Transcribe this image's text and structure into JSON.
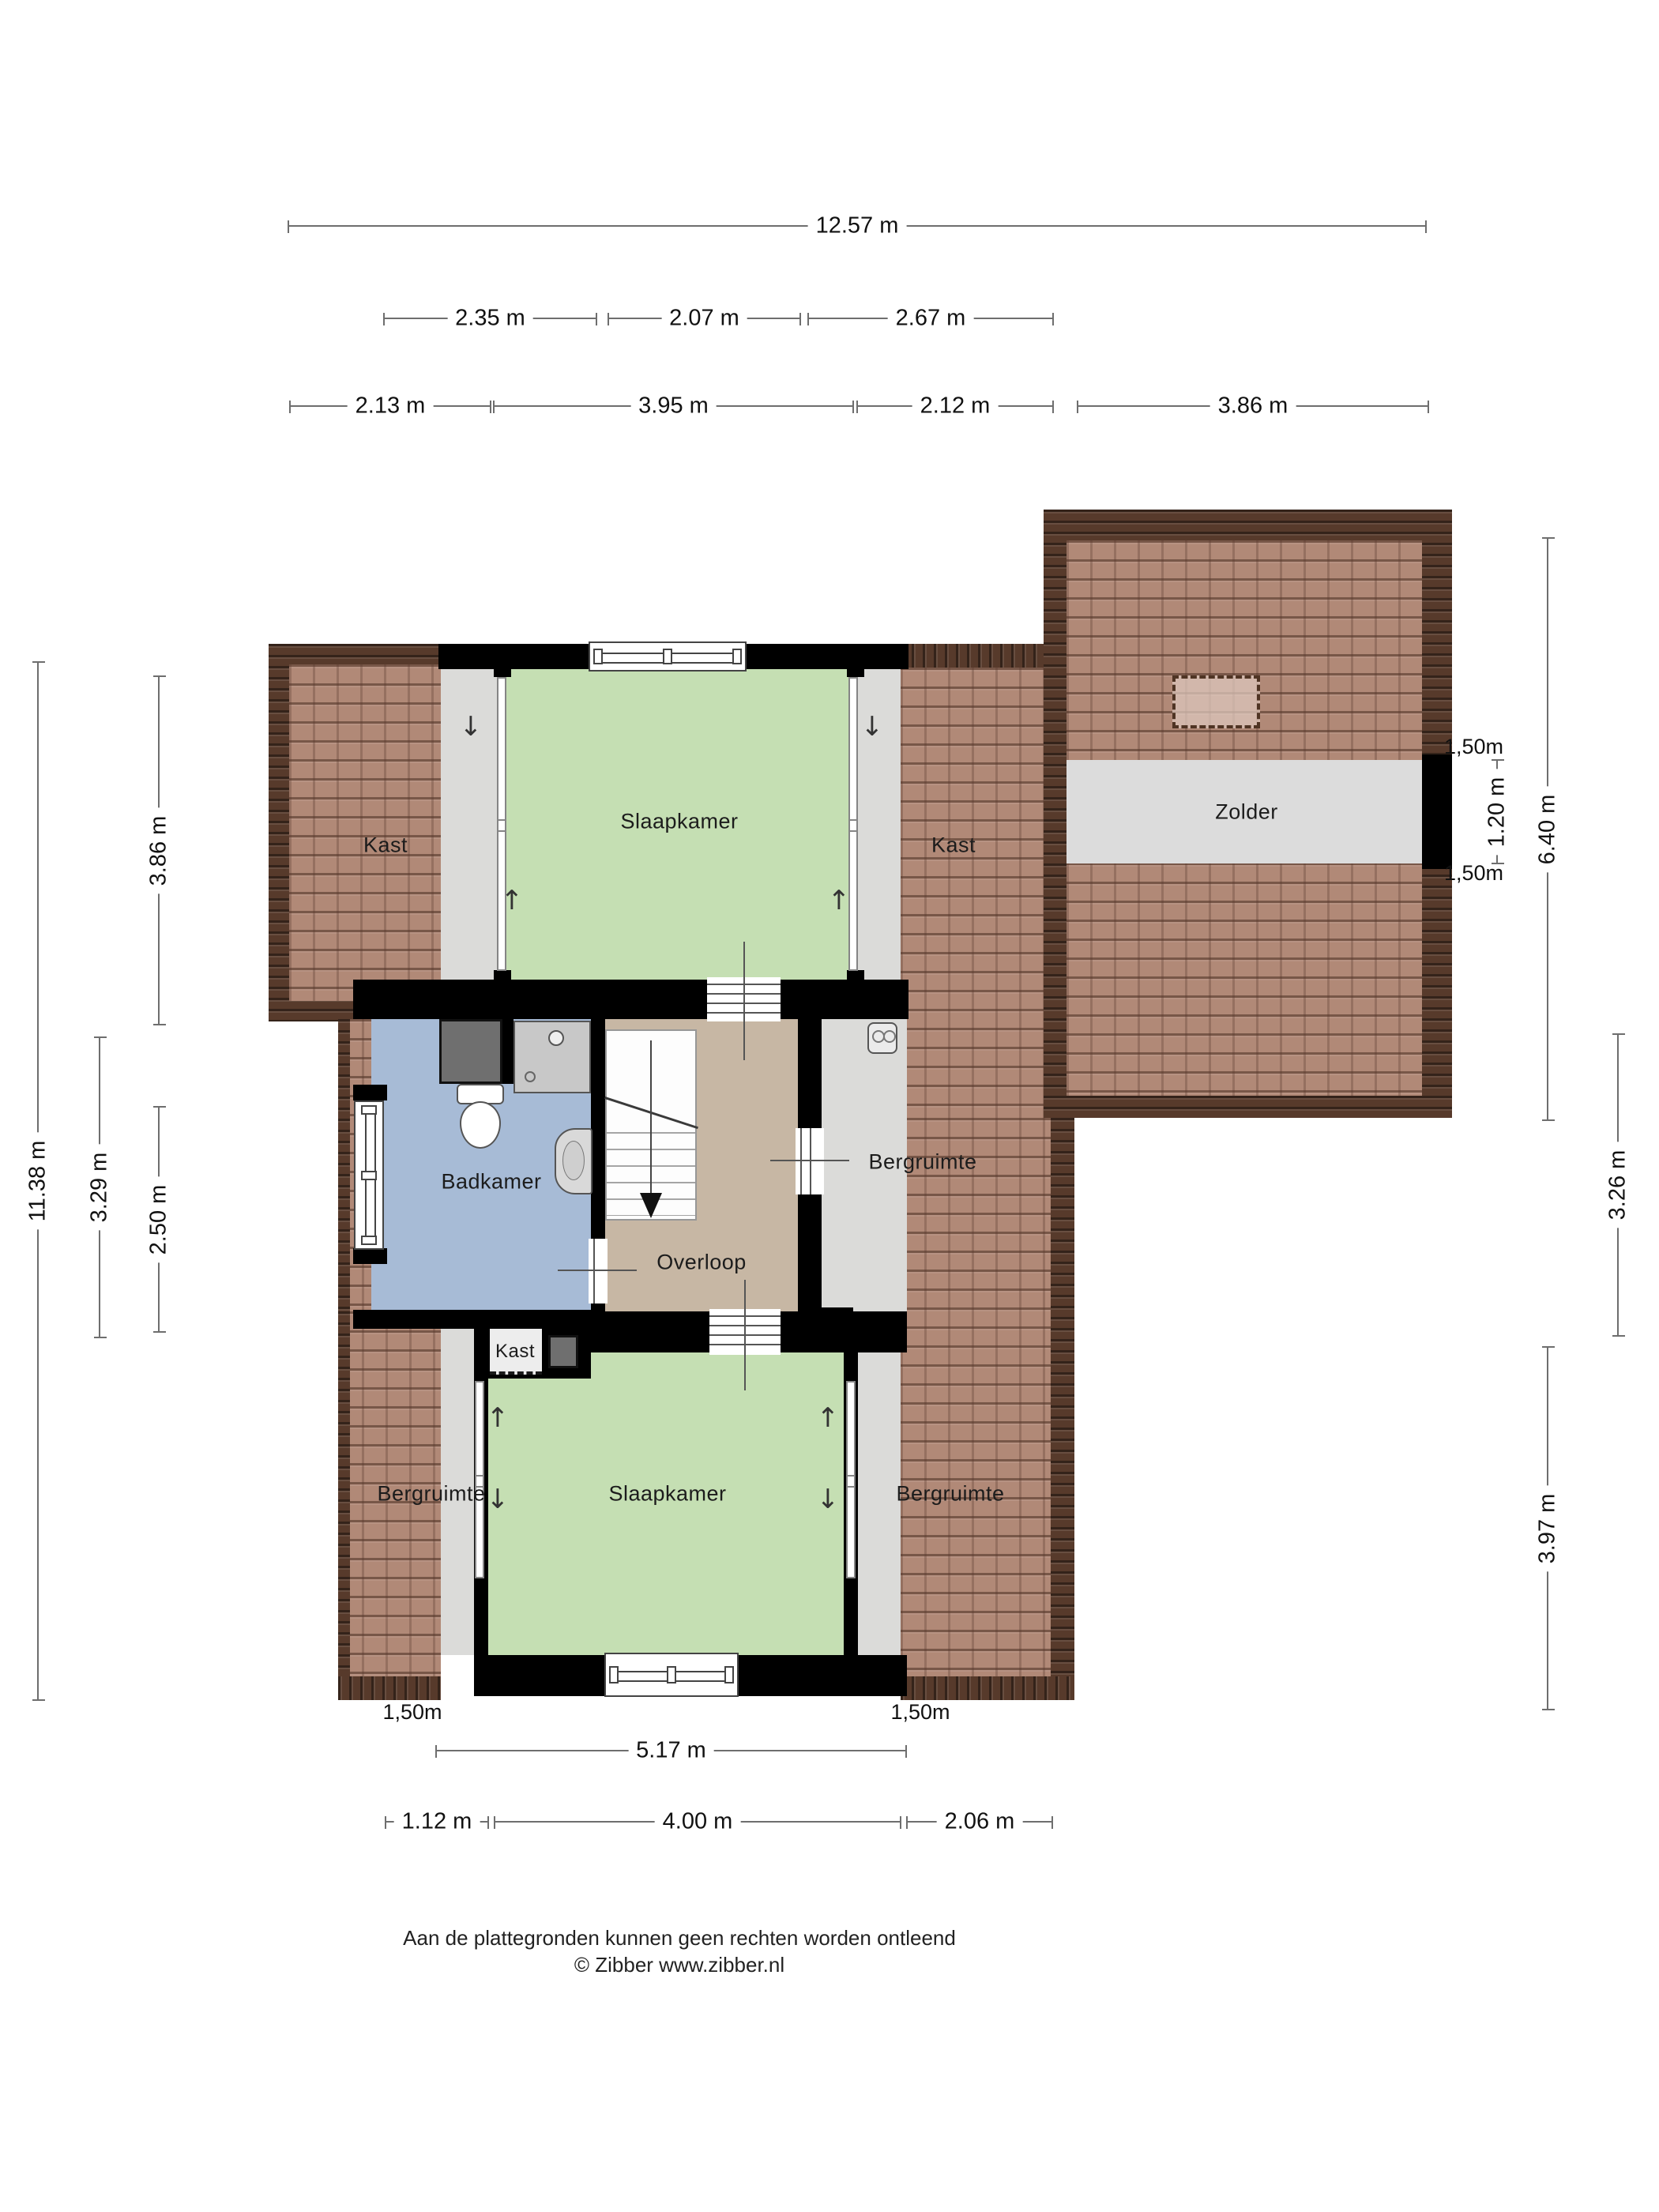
{
  "rooms": {
    "kast_left": "Kast",
    "slaapkamer_top": "Slaapkamer",
    "kast_right": "Kast",
    "zolder": "Zolder",
    "badkamer": "Badkamer",
    "overloop": "Overloop",
    "bergruimte_mid": "Bergruimte",
    "kast_small": "Kast",
    "bergruimte_bottom_left": "Bergruimte",
    "slaapkamer_bottom": "Slaapkamer",
    "bergruimte_bottom_right": "Bergruimte"
  },
  "dims": {
    "top_total": "12.57 m",
    "row2": [
      "2.35 m",
      "2.07 m",
      "2.67 m"
    ],
    "row3": [
      "2.13 m",
      "3.95 m",
      "2.12 m",
      "3.86 m"
    ],
    "left": [
      "11.38 m",
      "3.86 m",
      "3.29 m",
      "2.50 m"
    ],
    "right": {
      "r150_top": "1,50m",
      "r120": "1.20 m",
      "r640": "6.40 m",
      "r150_bottom": "1,50m",
      "r326": "3.26 m",
      "r397": "3.97 m"
    },
    "bottom": {
      "b150_left": "1,50m",
      "b150_right": "1,50m",
      "b517": "5.17 m",
      "row": [
        "1.12 m",
        "4.00 m",
        "2.06 m"
      ]
    }
  },
  "arrows": {
    "up": "↑",
    "down": "↓"
  },
  "footer": {
    "line1": "Aan de plattegronden kunnen geen rechten worden ontleend",
    "line2": "© Zibber www.zibber.nl"
  },
  "colors": {
    "wall": "#000000",
    "roof_tile": "#b18977",
    "roof_ridge": "#573a2b",
    "floor_gray": "#dbdbd9",
    "bedroom_green": "#c5dfb3",
    "bathroom_blue": "#a7bbd6",
    "landing_tan": "#c7b7a4",
    "attic_gray": "#dcdcdc"
  }
}
